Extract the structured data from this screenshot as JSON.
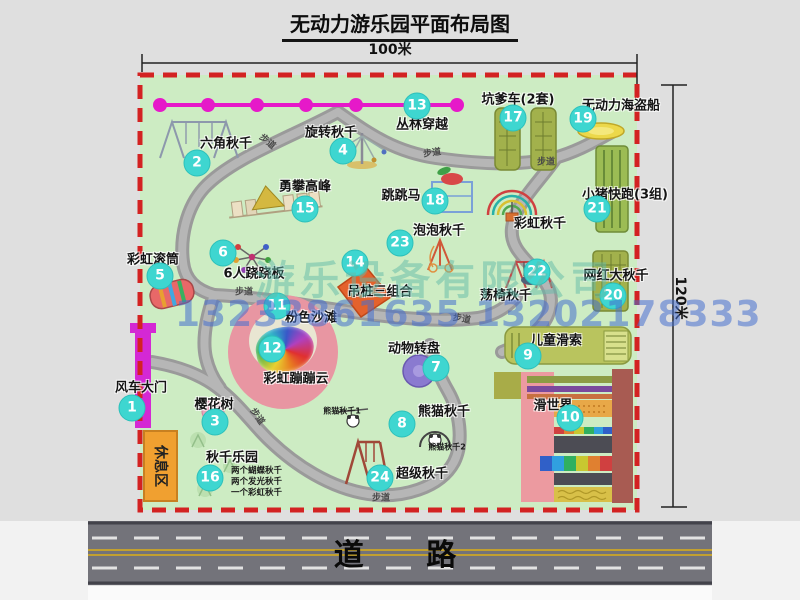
{
  "title": "无动力游乐园平面布局图",
  "dimensions": {
    "width_label": "100米",
    "height_label": "120米"
  },
  "road_label": "道 路",
  "watermark": {
    "company": "游乐设备有限公司",
    "phone": "13233861635 13202178333"
  },
  "labels": {
    "walkway": "步道",
    "rest_area": "休息区",
    "rainbow_swing": "彩虹秋千",
    "panda1": "熊猫秋千1",
    "panda2": "熊猫秋千2"
  },
  "colors": {
    "park_green": "#cdecc3",
    "border_red": "#d32222",
    "badge_teal": "#3ed6d0",
    "zipline_magenta": "#e619c9",
    "gate_magenta": "#d428d4",
    "rest_area_orange": "#f0a030",
    "road_gray": "#73737a"
  },
  "attractions": [
    {
      "num": "1",
      "label": "风车大门"
    },
    {
      "num": "2",
      "label": "六角秋千"
    },
    {
      "num": "3",
      "label": "樱花树"
    },
    {
      "num": "4",
      "label": "旋转秋千"
    },
    {
      "num": "5",
      "label": "彩虹滚筒"
    },
    {
      "num": "6",
      "label": "6人跷跷板"
    },
    {
      "num": "7",
      "label": "动物转盘"
    },
    {
      "num": "8",
      "label": "熊猫秋千"
    },
    {
      "num": "9",
      "label": "儿童滑索"
    },
    {
      "num": "10",
      "label": "滑世界"
    },
    {
      "num": "11",
      "label": "粉色沙滩"
    },
    {
      "num": "12",
      "label": "彩虹蹦蹦云"
    },
    {
      "num": "13",
      "label": "丛林穿越"
    },
    {
      "num": "14",
      "label": "吊桩三组合"
    },
    {
      "num": "15",
      "label": "勇攀高峰"
    },
    {
      "num": "16",
      "label": "秋千乐园",
      "notes": [
        "两个蝴蝶秋千",
        "两个发光秋千",
        "一个彩虹秋千"
      ]
    },
    {
      "num": "17",
      "label": "坑爹车(2套)"
    },
    {
      "num": "18",
      "label": "跳跳马"
    },
    {
      "num": "19",
      "label": "无动力海盗船"
    },
    {
      "num": "20",
      "label": "网红大秋千"
    },
    {
      "num": "21",
      "label": "小猪快跑(3组)"
    },
    {
      "num": "22",
      "label": "荡椅秋千"
    },
    {
      "num": "23",
      "label": "泡泡秋千"
    },
    {
      "num": "24",
      "label": "超级秋千"
    }
  ]
}
